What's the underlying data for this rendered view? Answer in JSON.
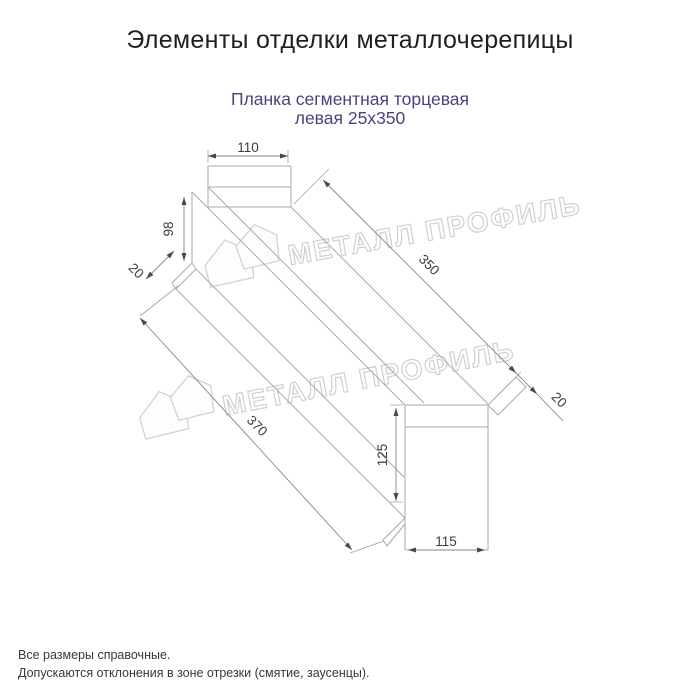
{
  "header": {
    "title": "Элементы отделки металлочерепицы"
  },
  "product": {
    "name_line1": "Планка сегментная торцевая",
    "name_line2": "левая 25х350"
  },
  "diagram": {
    "dimensions": {
      "flange_width": "110",
      "side_height": "98",
      "near_hem": "20",
      "length": "350",
      "far_hem": "20",
      "total_length": "370",
      "end_height": "125",
      "end_width": "115"
    }
  },
  "watermark": {
    "text": "МЕТАЛЛ ПРОФИЛЬ",
    "logo": "metall-profil-house-logo"
  },
  "footer": {
    "note1": "Все размеры справочные.",
    "note2": "Допускаются отклонения в зоне отрезки (смятие, заусенцы)."
  },
  "colors": {
    "title": "#1f1f1f",
    "subtitle": "#45457e",
    "drawing_line": "#a9aab0",
    "dimension_text": "#3c3c3c",
    "watermark": "#d0d0d2",
    "footer_text": "#38383a"
  }
}
